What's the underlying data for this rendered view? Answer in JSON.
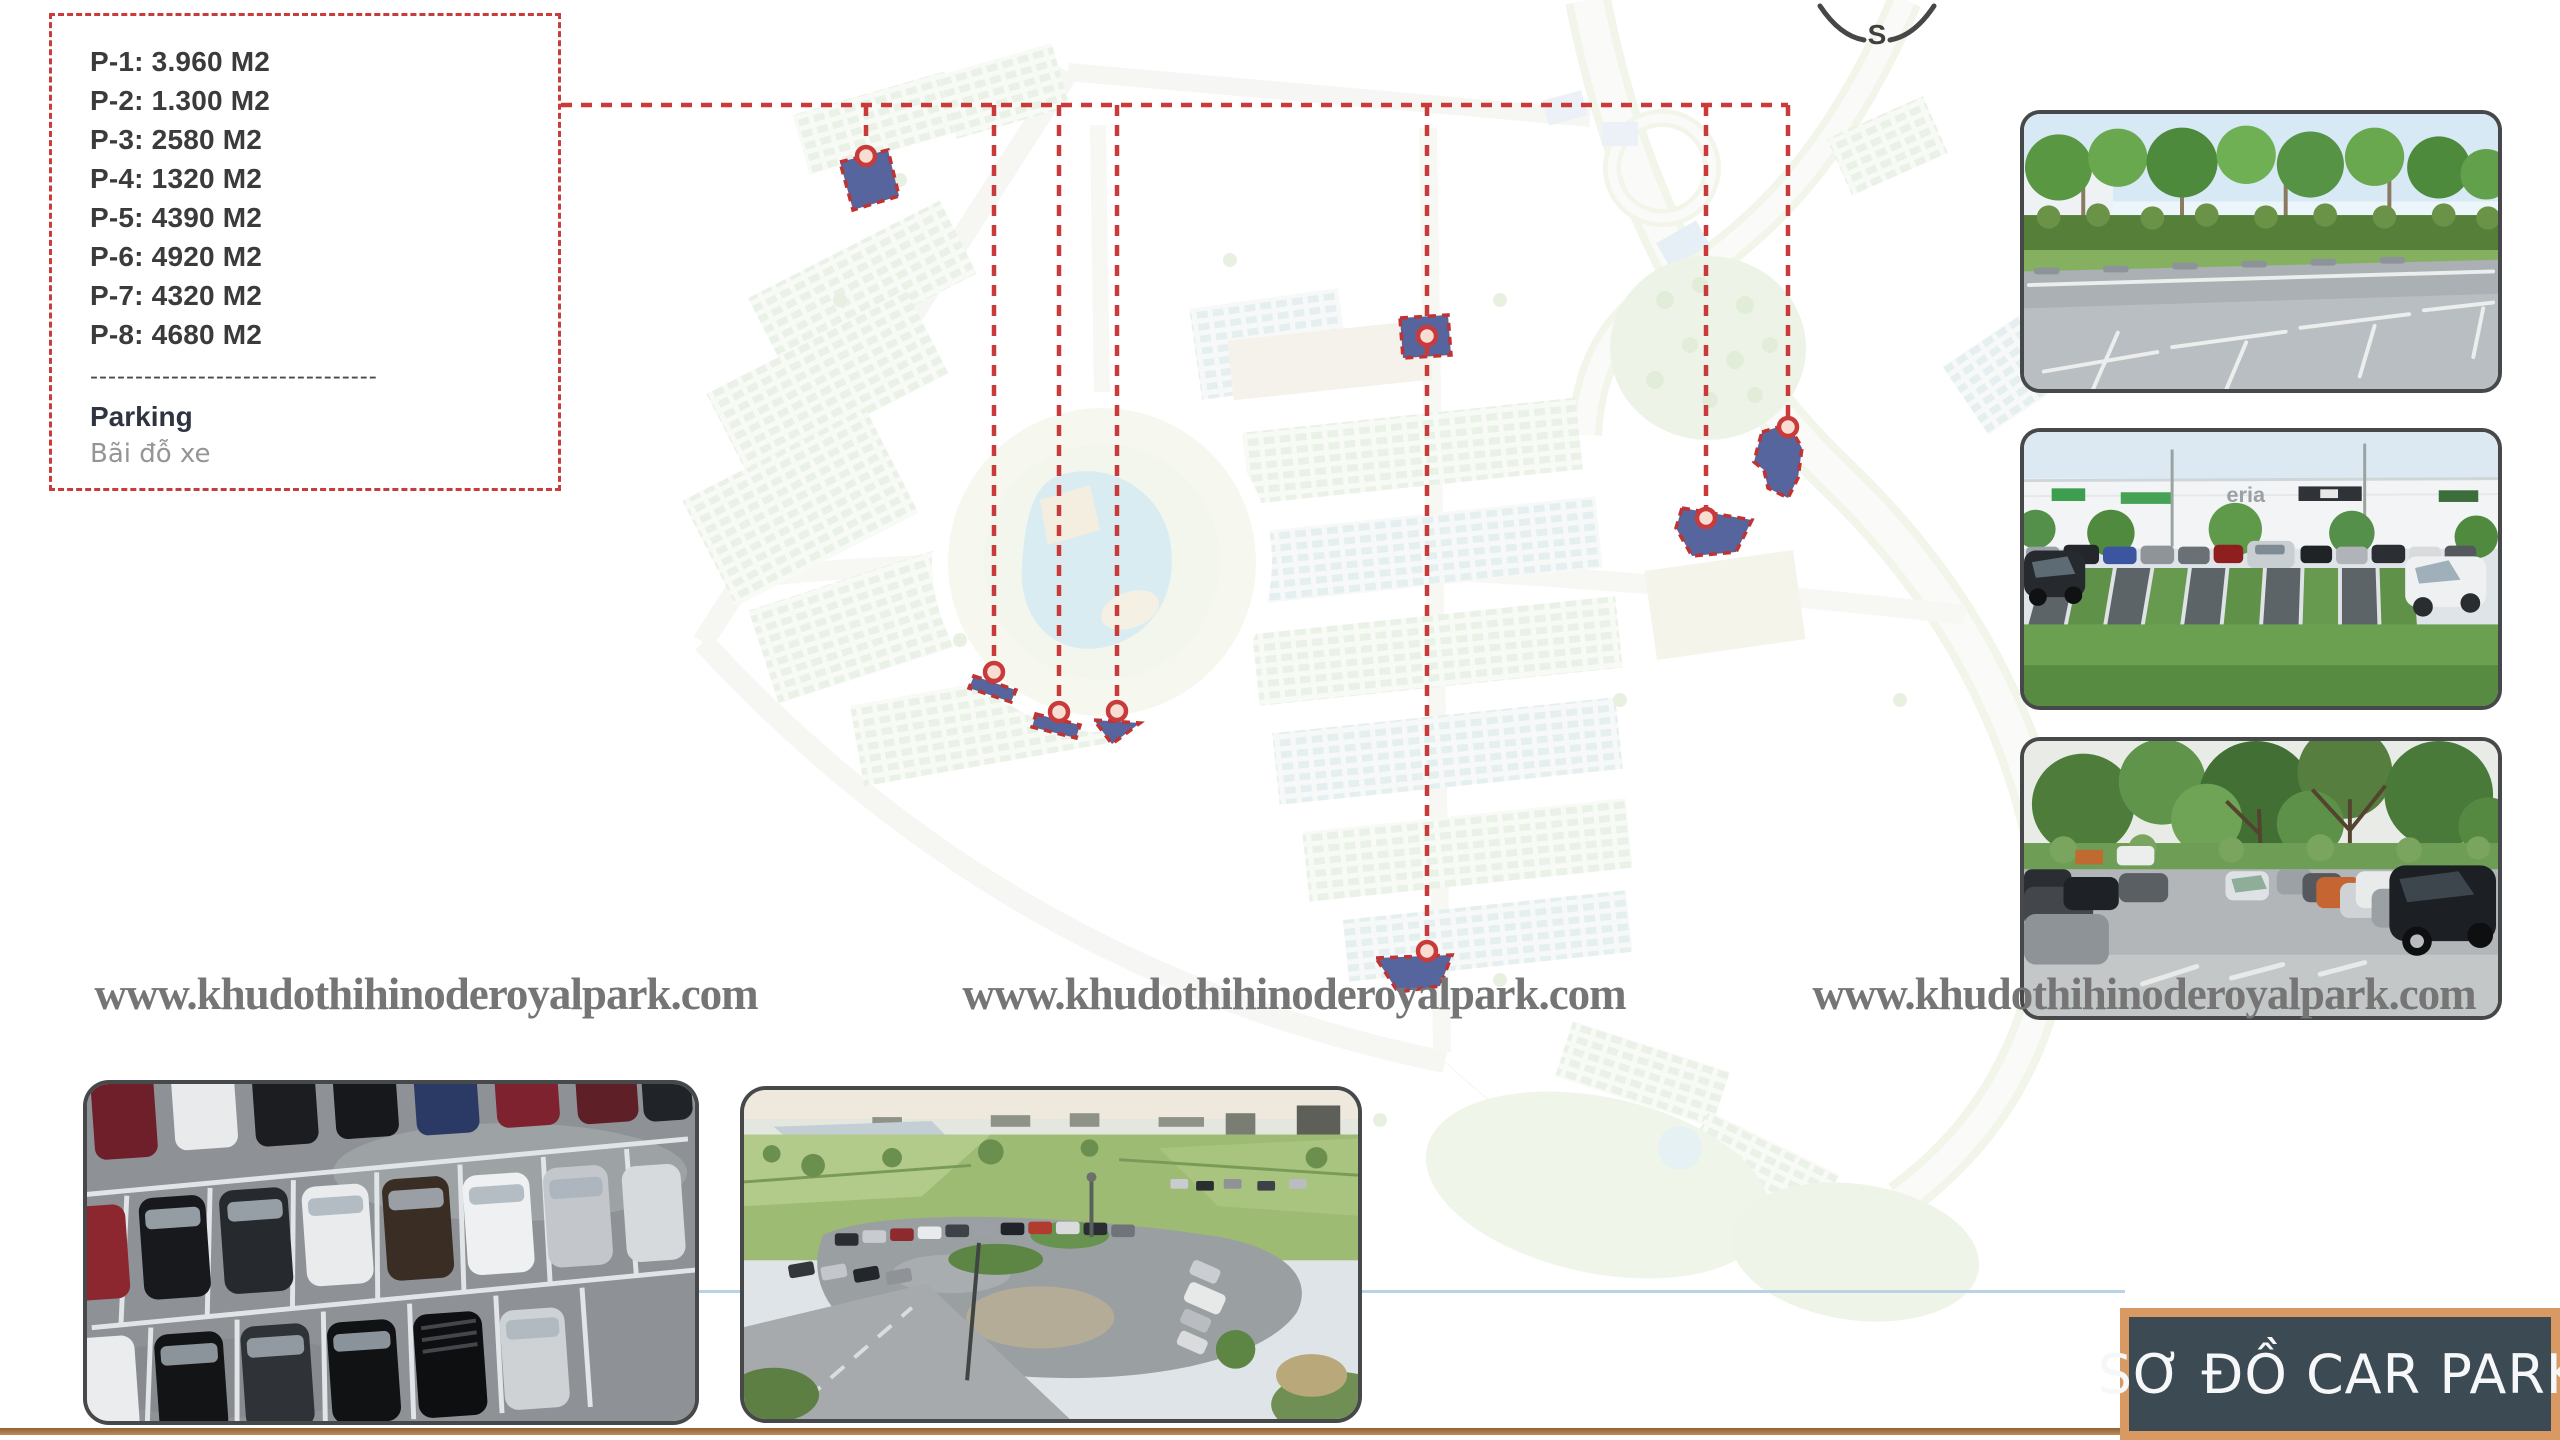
{
  "slide": {
    "background": "#ffffff"
  },
  "legend": {
    "items": [
      "P-1: 3.960 M2",
      "P-2: 1.300 M2",
      "P-3: 2580 M2",
      "P-4: 1320 M2",
      "P-5: 4390 M2",
      "P-6: 4920 M2",
      "P-7: 4320 M2",
      "P-8: 4680 M2"
    ],
    "separator": "--------------------------------",
    "title": "Parking",
    "subtitle": "Bãi đỗ xe",
    "border_color": "#c93c3c"
  },
  "compass": {
    "south_label": "S"
  },
  "watermark": {
    "text": "www.khudothihinoderoyalpark.com",
    "color": "#757575"
  },
  "map": {
    "dashed_line_color": "#c93a3a",
    "parking_plot_color": "#4d5d98",
    "marker_fill": "#f7ddd2",
    "plots_shown": 8
  },
  "photos": {
    "right": [
      {
        "alt": "empty parking bays beside trees and hedge"
      },
      {
        "alt": "retail warehouse car park with parked cars",
        "sign": "eria"
      },
      {
        "alt": "car park under large tropical trees"
      }
    ],
    "bottom": [
      {
        "alt": "aerial view of parked cars on wet asphalt"
      },
      {
        "alt": "rural car park surrounded by green fields"
      }
    ]
  },
  "title_box": {
    "text": "SƠ ĐỒ CAR PARK",
    "background": "#3c4a53",
    "border_color": "#d89a62",
    "text_color": "#f5f7f8"
  }
}
